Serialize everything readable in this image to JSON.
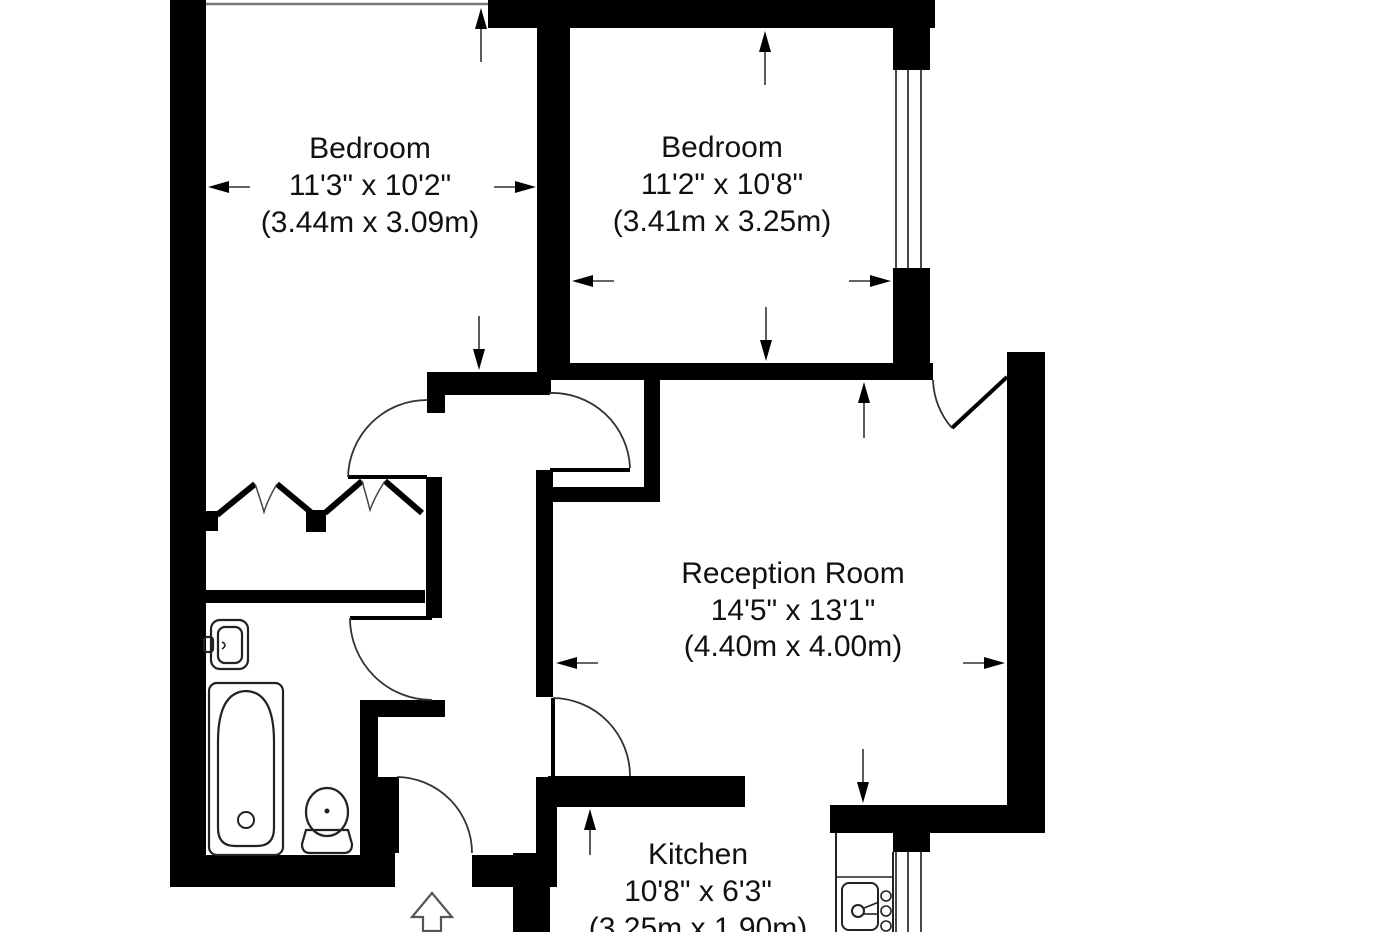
{
  "plan": {
    "type": "floorplan",
    "rooms": [
      {
        "name": "Bedroom",
        "imperial": "11'3\" x 10'2\"",
        "metric": "(3.44m x 3.09m)"
      },
      {
        "name": "Bedroom",
        "imperial": "11'2\" x 10'8\"",
        "metric": "(3.41m x 3.25m)"
      },
      {
        "name": "Reception Room",
        "imperial": "14'5\" x 13'1\"",
        "metric": "(4.40m x 4.00m)"
      },
      {
        "name": "Kitchen",
        "imperial": "10'8\" x 6'3\"",
        "metric": "(3.25m x 1.90m)"
      }
    ],
    "fixtures": [
      "bathtub",
      "bathroom-sink",
      "toilet",
      "kitchen-sink-counter",
      "wardrobe-bifold-doors"
    ],
    "symbols": {
      "entrance": "up-arrow-outline"
    },
    "colors": {
      "wall": "#000000",
      "background": "#ffffff",
      "text": "#111111",
      "window_line": "#777777",
      "arc": "#333333"
    }
  }
}
